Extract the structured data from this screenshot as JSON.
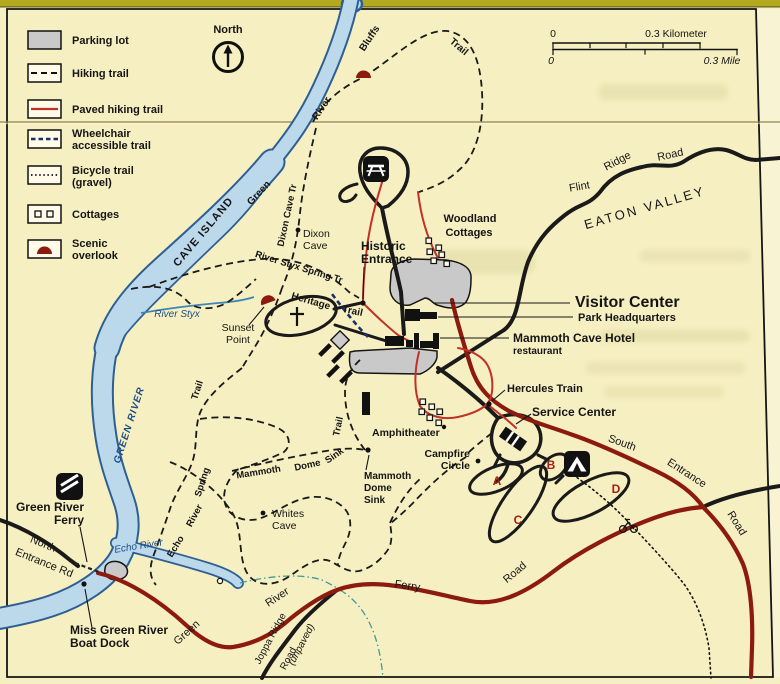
{
  "legend": {
    "items": [
      {
        "icon": "parking-lot-swatch",
        "lines": [
          "Parking lot"
        ]
      },
      {
        "icon": "hiking-trail-swatch",
        "lines": [
          "Hiking trail"
        ]
      },
      {
        "icon": "paved-hiking-trail-swatch",
        "lines": [
          "Paved hiking trail"
        ]
      },
      {
        "icon": "wheelchair-trail-swatch",
        "lines": [
          "Wheelchair",
          "accessible trail"
        ]
      },
      {
        "icon": "bicycle-trail-swatch",
        "lines": [
          "Bicycle trail",
          "(gravel)"
        ]
      },
      {
        "icon": "cottages-swatch",
        "lines": [
          "Cottages"
        ]
      },
      {
        "icon": "scenic-overlook-swatch",
        "lines": [
          "Scenic",
          "overlook"
        ]
      }
    ]
  },
  "compass": {
    "label": "North"
  },
  "scale_bar": {
    "km_start": "0",
    "km_end": "0.3 Kilometer",
    "mile_start": "0",
    "mile_end": "0.3 Mile"
  },
  "water": {
    "green_river_caps": "GREEN RIVER",
    "river_styx": "River Styx",
    "echo_river": "Echo River",
    "cave_island": "CAVE ISLAND"
  },
  "roads": {
    "flint_ridge": [
      "Flint",
      "Ridge",
      "Road"
    ],
    "south_entrance": [
      "South",
      "Entrance",
      "Road"
    ],
    "north_entrance": [
      "North",
      "Entrance Rd"
    ],
    "green_river_ferry": [
      "Green",
      "River",
      "Ferry",
      "Road"
    ],
    "joppa_ridge": [
      "Joppa Ridge",
      "Road",
      "(unpaved)"
    ]
  },
  "trails": {
    "green_river_bluffs": [
      "Green",
      "River",
      "Bluffs",
      "Trail"
    ],
    "dixon_cave": "Dixon Cave Tr",
    "river_styx_spring": "River Styx Spring Tr",
    "heritage": [
      "Heritage",
      "Trail"
    ],
    "echo_river_spring": [
      "Echo",
      "River",
      "Spring",
      "Trail"
    ],
    "mammoth_dome_sink": [
      "Mammoth",
      "Dome",
      "Sink",
      "Trail"
    ]
  },
  "places": {
    "eaton_valley": "EATON VALLEY",
    "visitor_center": "Visitor Center",
    "park_headquarters": "Park Headquarters",
    "mammoth_cave_hotel": "Mammoth Cave Hotel",
    "restaurant": "restaurant",
    "hercules_train": "Hercules Train",
    "service_center": "Service Center",
    "amphitheater": "Amphitheater",
    "campfire_circle": [
      "Campfire",
      "Circle"
    ],
    "woodland_cottages": [
      "Woodland",
      "Cottages"
    ],
    "historic_entrance": [
      "Historic",
      "Entrance"
    ],
    "dixon_cave": [
      "Dixon",
      "Cave"
    ],
    "whites_cave": [
      "Whites",
      "Cave"
    ],
    "sunset_point": [
      "Sunset",
      "Point"
    ],
    "mammoth_dome_sink": [
      "Mammoth",
      "Dome",
      "Sink"
    ],
    "green_river_ferry": [
      "Green River",
      "Ferry"
    ],
    "boat_dock": [
      "Miss Green River",
      "Boat Dock"
    ]
  },
  "campground": {
    "loop_labels": [
      "A",
      "B",
      "C",
      "D"
    ]
  },
  "icons": {
    "picnic_area": "picnic-table-icon",
    "campground": "tent-icon",
    "ferry": "ferry-icon",
    "bicycle": "bicycle-icon",
    "north_arrow": "north-arrow-icon",
    "cemetery": "cross-icon",
    "scenic_overlook": "overlook-dome-icon"
  },
  "colors": {
    "paper": "#f6efc1",
    "road_paved": "#8c1a0e",
    "trail_paved": "#c23128",
    "water_fill": "#bcd9ec",
    "water_outline": "#2e5f94",
    "water_label": "#1d4e89",
    "parking_fill": "#c9c9c9",
    "overlook": "#8c1a0e",
    "wheelchair_trail": "#1c2d6b",
    "camp_letter": "#a32014",
    "fold_strip": "#b3aa1f"
  }
}
